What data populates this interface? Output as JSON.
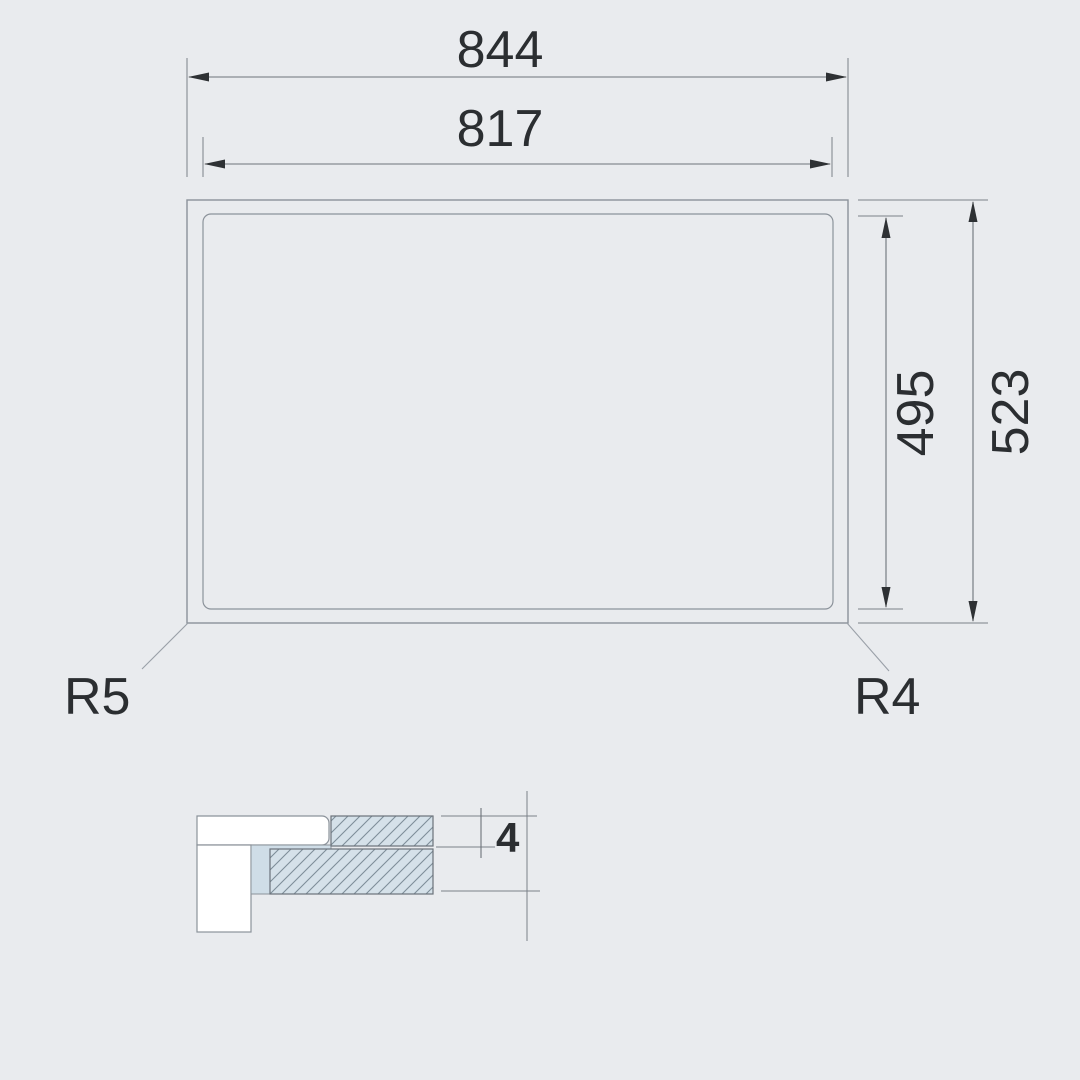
{
  "plan_view": {
    "outer_width": "844",
    "inner_width": "817",
    "inner_height": "495",
    "outer_height": "523",
    "corner_radius_bottom_left": "R5",
    "corner_radius_bottom_right": "R4"
  },
  "section_detail": {
    "glass_thickness": "4"
  },
  "colors": {
    "background": "#e9ebee",
    "outline": "#8b929a",
    "dimension_line": "#6d737a",
    "arrow": "#2e3134",
    "text": "#2b2e31",
    "hatch_fill": "#d5e1e9",
    "hatch_line": "#7e8e99",
    "seal_fill": "#cfdde7",
    "white_fill": "#ffffff"
  }
}
